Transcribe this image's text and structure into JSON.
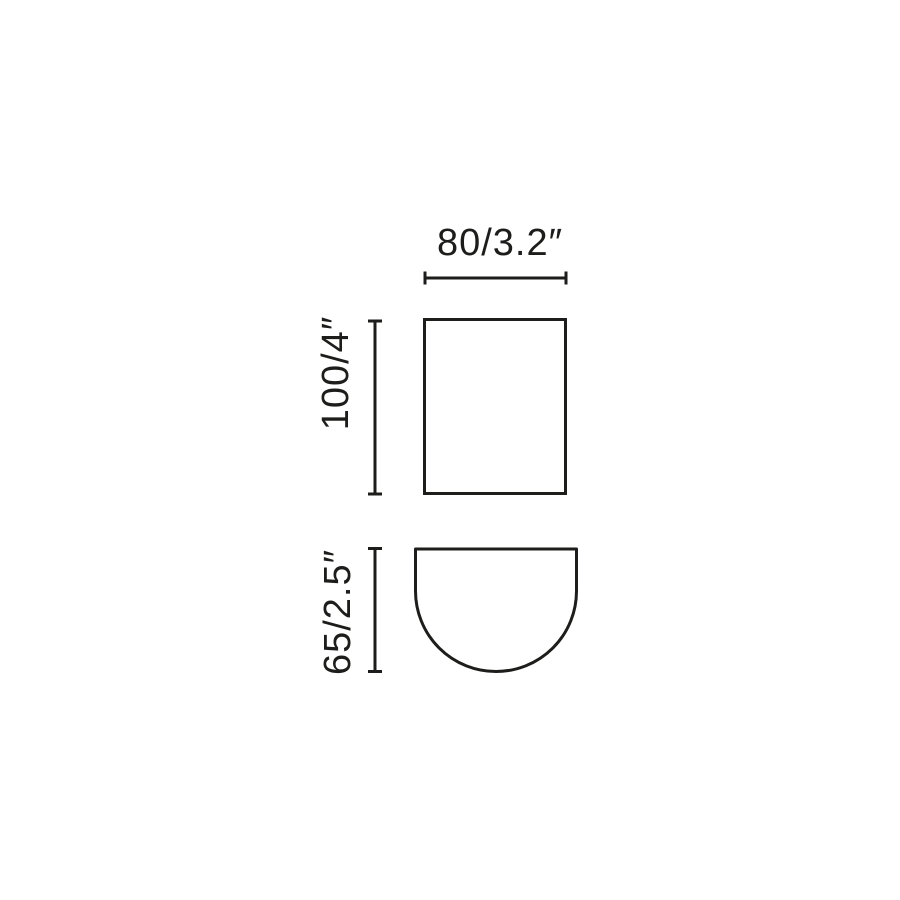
{
  "diagram": {
    "type": "product-dimension-drawing",
    "background_color": "#ffffff",
    "line_color": "#1d1d1b",
    "views": {
      "front": {
        "shape": "rectangle"
      },
      "side": {
        "shape": "half-round"
      }
    },
    "dimensions": {
      "width": {
        "label": "80/3.2″",
        "mm": 80,
        "inches": 3.2
      },
      "height": {
        "label": "100/4″",
        "mm": 100,
        "inches": 4
      },
      "depth": {
        "label": "65/2.5″",
        "mm": 65,
        "inches": 2.5
      }
    }
  }
}
